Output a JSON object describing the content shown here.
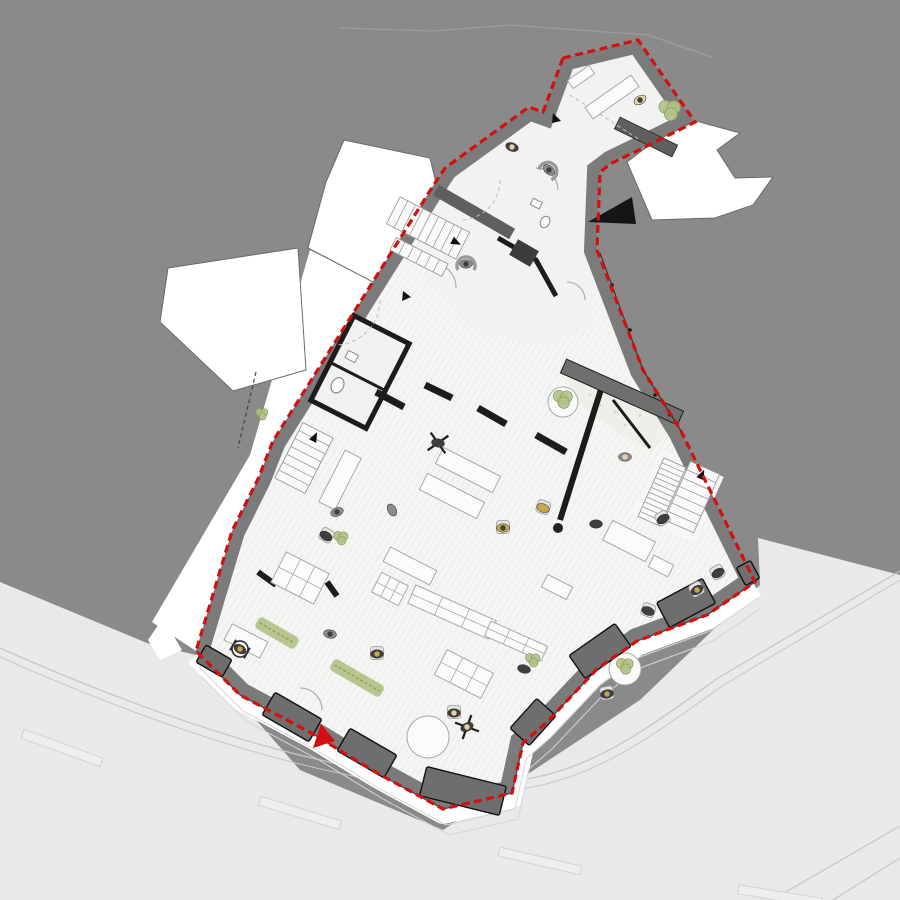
{
  "colors": {
    "context": "#8a8a8a",
    "seam": "#9d9d9d",
    "street": "#e9e9e9",
    "curb": "#c6c6c6",
    "floor": "#f5f5f4",
    "floor_plain": "#f2f2f1",
    "hatch_line": "#e2e2df",
    "wall": "#7b7b7b",
    "wall_dark": "#1c1c1c",
    "boundary_red": "#d40f0f",
    "pier": "#6e6e6e",
    "green": "#b3c289",
    "green_dark": "#8fa061",
    "ochre": "#c7a54a",
    "skin": "#e8d0a2",
    "person_dark": "#3f3f3f",
    "person_gray": "#8c8c8c",
    "furniture_stroke": "#a8a8a8",
    "sidewalk": "#ffffff",
    "entrance_arrow": "#d40f0f"
  },
  "plan": {
    "piers": [
      [
        292,
        717,
        54,
        26,
        30
      ],
      [
        367,
        753,
        54,
        26,
        30
      ],
      [
        463,
        791,
        82,
        30,
        14
      ],
      [
        533,
        722,
        40,
        26,
        -48
      ],
      [
        600,
        651,
        56,
        28,
        -35
      ],
      [
        686,
        603,
        52,
        28,
        -28
      ],
      [
        748,
        573,
        16,
        20,
        -28
      ],
      [
        214,
        661,
        30,
        20,
        30
      ]
    ],
    "furniture_rects": [
      [
        468,
        470,
        64,
        18,
        27,
        0
      ],
      [
        452,
        496,
        64,
        18,
        27,
        0
      ],
      [
        410,
        566,
        52,
        16,
        27,
        0
      ],
      [
        452,
        612,
        88,
        20,
        24,
        1
      ],
      [
        516,
        641,
        62,
        16,
        24,
        1
      ],
      [
        557,
        587,
        28,
        14,
        27,
        0
      ],
      [
        629,
        541,
        48,
        22,
        27,
        0
      ],
      [
        661,
        566,
        22,
        13,
        27,
        0
      ],
      [
        300,
        578,
        48,
        34,
        27,
        1
      ],
      [
        390,
        589,
        30,
        22,
        27,
        1
      ],
      [
        464,
        674,
        52,
        28,
        27,
        1
      ],
      [
        246,
        641,
        40,
        18,
        27,
        0
      ],
      [
        340,
        480,
        18,
        58,
        27,
        0
      ],
      [
        612,
        97,
        56,
        14,
        -35,
        0
      ],
      [
        581,
        77,
        26,
        10,
        -35,
        0
      ]
    ],
    "furniture_circles": [
      [
        428,
        737,
        21
      ],
      [
        625,
        669,
        16
      ],
      [
        563,
        402,
        15
      ]
    ],
    "plants_round": [
      [
        670,
        110,
        9
      ],
      [
        563,
        399,
        8
      ],
      [
        625,
        666,
        7
      ],
      [
        533,
        660,
        6
      ],
      [
        341,
        538,
        6
      ],
      [
        262,
        414,
        5
      ]
    ],
    "plant_strips": [
      [
        277,
        633,
        46,
        13,
        30
      ],
      [
        357,
        678,
        58,
        13,
        30
      ]
    ],
    "stairs": [
      {
        "x": 428,
        "y": 228,
        "rot": 27,
        "w": 78,
        "h": 30,
        "axis": "x",
        "steps": 9,
        "arrow": true
      },
      {
        "x": 419,
        "y": 257,
        "rot": 27,
        "w": 58,
        "h": 14,
        "axis": "x",
        "steps": 6,
        "arrow": false
      },
      {
        "x": 304,
        "y": 458,
        "rot": 27,
        "w": 34,
        "h": 62,
        "axis": "y",
        "steps": 7,
        "arrow": true
      },
      {
        "x": 662,
        "y": 492,
        "rot": 24,
        "w": 24,
        "h": 64,
        "axis": "y",
        "steps": 12,
        "arrow": false
      },
      {
        "x": 692,
        "y": 497,
        "rot": 24,
        "w": 32,
        "h": 64,
        "axis": "y",
        "steps": 7,
        "arrow": true
      }
    ],
    "lane_dashes": [
      [
        62,
        748,
        84,
        9,
        20
      ],
      [
        300,
        813,
        84,
        9,
        17
      ],
      [
        540,
        861,
        84,
        9,
        13
      ],
      [
        780,
        896,
        84,
        9,
        9
      ]
    ],
    "people": [
      {
        "x": 640,
        "y": 100,
        "rot": -30,
        "kind": "stand",
        "body": "skin",
        "head": "dark"
      },
      {
        "x": 512,
        "y": 147,
        "rot": 20,
        "kind": "stand",
        "body": "dark",
        "head": "skin"
      },
      {
        "x": 549,
        "y": 170,
        "rot": 40,
        "kind": "swivel",
        "body": "gray",
        "head": "dark"
      },
      {
        "x": 466,
        "y": 264,
        "rot": 0,
        "kind": "swivel",
        "body": "gray",
        "head": "dark"
      },
      {
        "x": 438,
        "y": 443,
        "rot": 10,
        "kind": "chairx",
        "body": "dark",
        "head": "dark"
      },
      {
        "x": 337,
        "y": 512,
        "rot": -20,
        "kind": "stand",
        "body": "gray",
        "head": "dark"
      },
      {
        "x": 326,
        "y": 536,
        "rot": 30,
        "kind": "sit",
        "body": "dark",
        "head": "dark"
      },
      {
        "x": 392,
        "y": 510,
        "rot": 60,
        "kind": "stand",
        "body": "gray",
        "head": "gray"
      },
      {
        "x": 503,
        "y": 528,
        "rot": 0,
        "kind": "sit",
        "body": "ochre",
        "head": "dark"
      },
      {
        "x": 543,
        "y": 508,
        "rot": 20,
        "kind": "sit",
        "body": "ochre",
        "head": "ochre"
      },
      {
        "x": 596,
        "y": 524,
        "rot": 0,
        "kind": "stand",
        "body": "dark",
        "head": "dark"
      },
      {
        "x": 663,
        "y": 519,
        "rot": -30,
        "kind": "sit",
        "body": "dark",
        "head": "dark"
      },
      {
        "x": 625,
        "y": 457,
        "rot": 0,
        "kind": "stand",
        "body": "gray",
        "head": "skin"
      },
      {
        "x": 718,
        "y": 573,
        "rot": -30,
        "kind": "sit",
        "body": "dark",
        "head": "dark"
      },
      {
        "x": 697,
        "y": 590,
        "rot": -30,
        "kind": "sit",
        "body": "dark",
        "head": "ochre"
      },
      {
        "x": 648,
        "y": 611,
        "rot": 20,
        "kind": "sit",
        "body": "dark",
        "head": "dark"
      },
      {
        "x": 607,
        "y": 694,
        "rot": -10,
        "kind": "sit",
        "body": "dark",
        "head": "ochre"
      },
      {
        "x": 524,
        "y": 669,
        "rot": 15,
        "kind": "stand",
        "body": "dark",
        "head": "dark"
      },
      {
        "x": 467,
        "y": 727,
        "rot": -25,
        "kind": "chairx",
        "body": "dark",
        "head": "skin"
      },
      {
        "x": 454,
        "y": 713,
        "rot": 0,
        "kind": "sit",
        "body": "dark",
        "head": "skin"
      },
      {
        "x": 330,
        "y": 634,
        "rot": 10,
        "kind": "stand",
        "body": "gray",
        "head": "dark"
      },
      {
        "x": 377,
        "y": 654,
        "rot": 0,
        "kind": "sit",
        "body": "dark",
        "head": "ochre"
      },
      {
        "x": 240,
        "y": 649,
        "rot": 30,
        "kind": "wheelchair",
        "body": "dark",
        "head": "ochre"
      }
    ]
  }
}
